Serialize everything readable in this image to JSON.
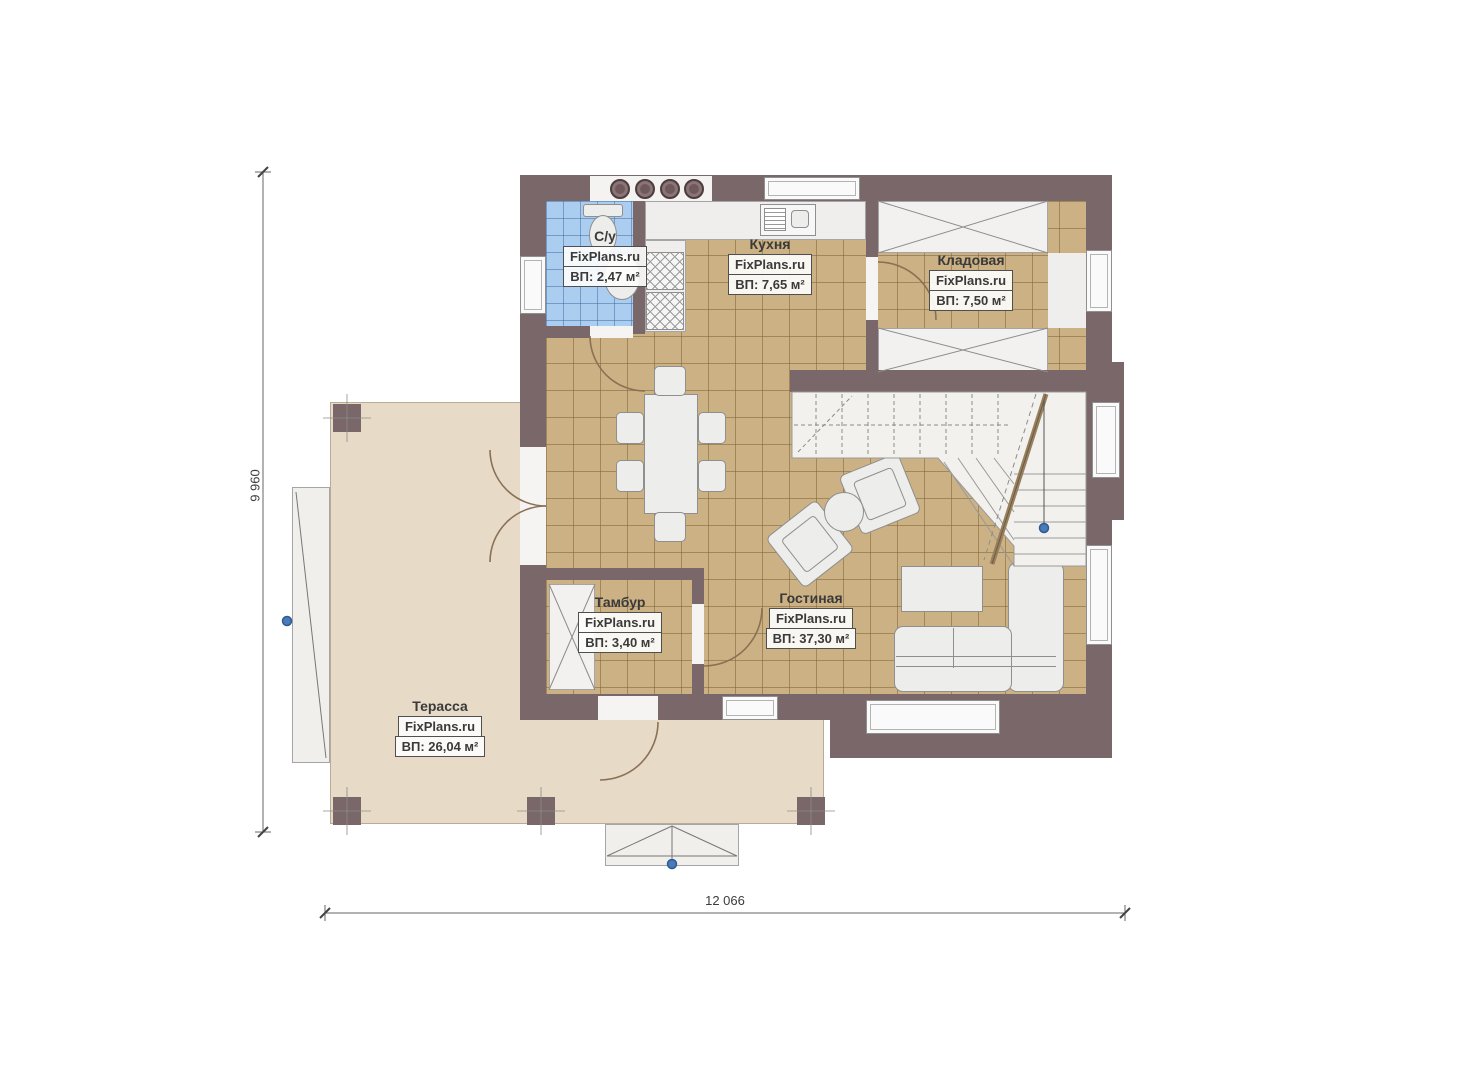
{
  "watermark": "FixPlans.ru",
  "rooms": [
    {
      "id": "bathroom",
      "name": "С/у",
      "area": "ВП: 2,47 м²"
    },
    {
      "id": "kitchen",
      "name": "Кухня",
      "area": "ВП: 7,65 м²"
    },
    {
      "id": "storage",
      "name": "Кладовая",
      "area": "ВП: 7,50 м²"
    },
    {
      "id": "vestibule",
      "name": "Тамбур",
      "area": "ВП: 3,40 м²"
    },
    {
      "id": "living",
      "name": "Гостиная",
      "area": "ВП: 37,30 м²"
    },
    {
      "id": "terrace",
      "name": "Терасса",
      "area": "ВП: 26,04 м²"
    }
  ],
  "dimensions": {
    "height_label": "9 960",
    "width_label": "12 066"
  },
  "colors": {
    "wall": "#7a6769",
    "floor_tile": "#ccb184",
    "bathroom_tile": "#aacdf0",
    "terrace": "#e7dbc7",
    "marker_blue": "#4a7ab8"
  }
}
